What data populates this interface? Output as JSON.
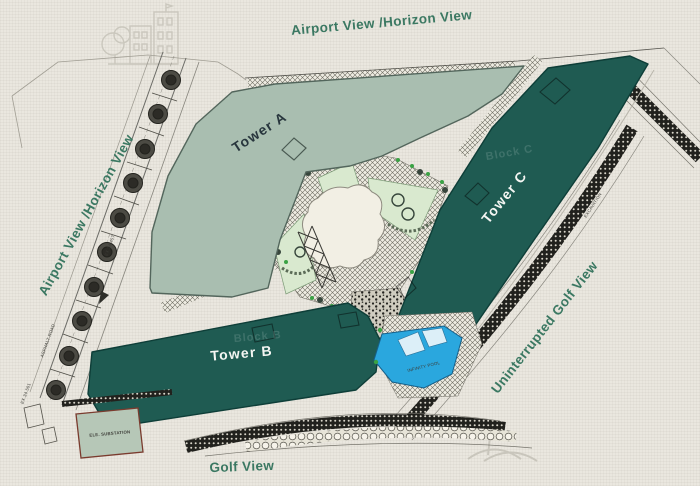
{
  "colors": {
    "bg": "#eae7df",
    "label-green": "#3b7862",
    "tower-teal": "#1f5b52",
    "tower-teal-dark": "#0e3e38",
    "sage": "#a9beb0",
    "sage-dark": "#53665c",
    "lawn": "#d9e9cf",
    "lawn-dark": "#7d9b78",
    "cream": "#f2efe4",
    "pool-blue": "#2aa7de",
    "pool-dark": "#16608a",
    "ink": "#2f3336",
    "faint": "#c6c3b9",
    "substation-fill": "#b6c7b7",
    "substation-border": "#7a3b2e"
  },
  "labels": {
    "view_top": "Airport View /Horizon View",
    "view_left": "Airport View /Horizon View",
    "view_right": "Uninterrupted Golf View",
    "view_bottom": "Golf View"
  },
  "towers": {
    "a": {
      "label": "Tower A"
    },
    "b": {
      "label": "Tower B",
      "block": "Block B"
    },
    "c": {
      "label": "Tower C",
      "block": "Block C"
    }
  },
  "features": {
    "pool": "INFINITY POOL",
    "substation": "ELE. SUBSTATION"
  },
  "roads": {
    "asphalt": "ASPHALT ROAD",
    "ex_top": "EX.34.457",
    "ex_bottom": "EX.34.501",
    "excavation": "EXCAVATION"
  },
  "icons": {
    "watermark_top_left": "buildings-logo",
    "watermark_bottom_right": "golf-flag"
  }
}
